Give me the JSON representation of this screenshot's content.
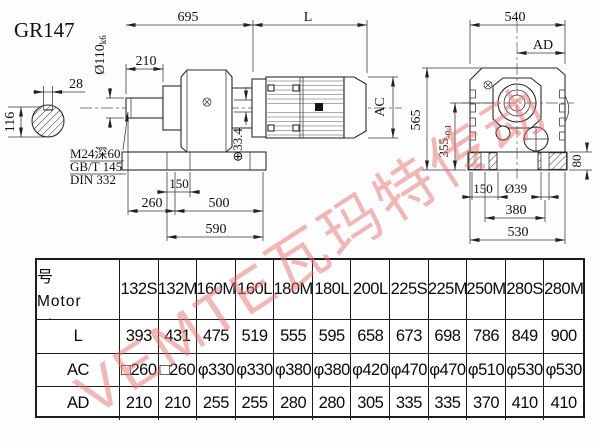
{
  "drawing": {
    "title": "GR147",
    "labels": {
      "dim_28": "28",
      "dim_116": "116",
      "dia_110": "Ø110",
      "dia_110_tol": "k6",
      "dim_695": "695",
      "dim_L": "L",
      "dim_210": "210",
      "thread_note_1": "M24深60",
      "thread_note_2": "GB/T 145",
      "thread_note_3": "DIN 332",
      "dim_150_front": "150",
      "dim_260": "260",
      "dim_500": "500",
      "dim_590": "590",
      "dim_33_4": "⊕33.4",
      "dim_AC": "AC",
      "dim_540": "540",
      "dim_AD": "AD",
      "dim_565": "565",
      "dim_355": "355",
      "dim_355_tol": "-0.1",
      "dim_80": "80",
      "dim_150_side": "150",
      "dia_39": "Ø39",
      "dim_380": "380",
      "dim_530": "530"
    }
  },
  "table": {
    "header": {
      "line1": "Y2电机机座号",
      "line2": "Motor Size"
    },
    "columns": [
      "132S",
      "132M",
      "160M",
      "160L",
      "180M",
      "180L",
      "200L",
      "225S",
      "225M",
      "250M",
      "280S",
      "280M"
    ],
    "rows": [
      {
        "label": "L",
        "values": [
          "393",
          "431",
          "475",
          "519",
          "555",
          "595",
          "658",
          "673",
          "698",
          "786",
          "849",
          "900"
        ]
      },
      {
        "label": "AC",
        "values": [
          "□260",
          "□260",
          "φ330",
          "φ330",
          "φ380",
          "φ380",
          "φ420",
          "φ470",
          "φ470",
          "φ510",
          "φ530",
          "φ530"
        ]
      },
      {
        "label": "AD",
        "values": [
          "210",
          "210",
          "255",
          "255",
          "280",
          "280",
          "305",
          "335",
          "335",
          "370",
          "410",
          "410"
        ]
      }
    ]
  },
  "watermark": {
    "text": "VEMTE瓦玛特传动",
    "color": "#e67070"
  }
}
